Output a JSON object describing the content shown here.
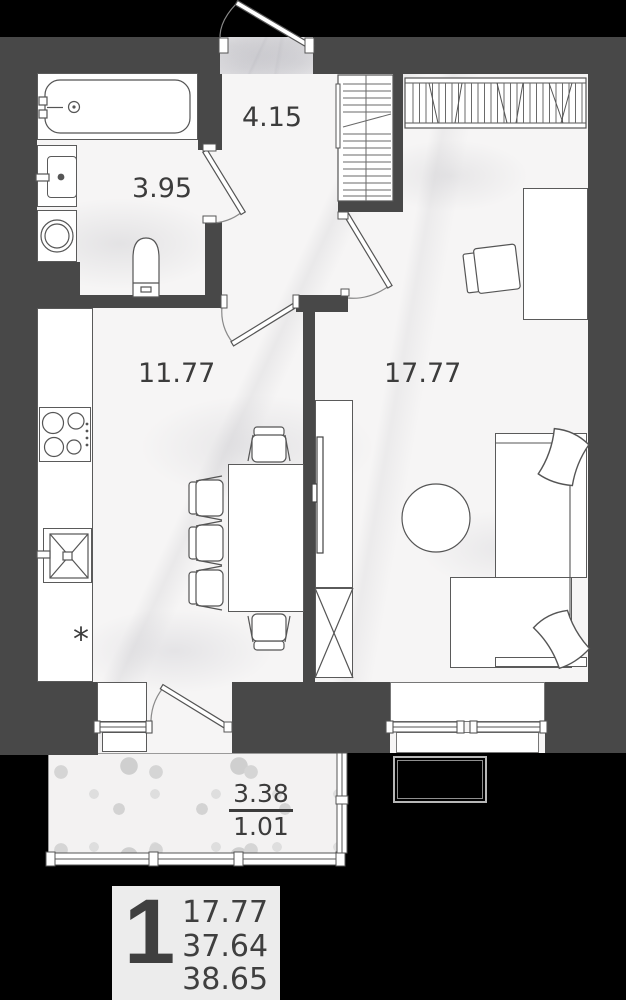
{
  "plan": {
    "rooms": [
      {
        "name": "hallway",
        "area": "4.15"
      },
      {
        "name": "bathroom",
        "area": "3.95"
      },
      {
        "name": "kitchen",
        "area": "11.77"
      },
      {
        "name": "living-room",
        "area": "17.77"
      }
    ],
    "balcony": {
      "area_total": "3.38",
      "area_counted": "1.01"
    },
    "fridge_marker": "*"
  },
  "legend": {
    "rooms_count": "1",
    "living_area": "17.77",
    "area_without_balcony": "37.64",
    "total_area": "38.65"
  },
  "colors": {
    "walls": "#484848",
    "background": "#000000",
    "floor": "#f6f5f5",
    "balcony_floor": "#f3f2f2",
    "outline": "#5a5a5a",
    "label_text": "#3c3c3c",
    "legend_bg": "#ececec"
  },
  "fixtures": [
    "bathtub",
    "washbasin",
    "washing-machine",
    "toilet",
    "built-in-closet",
    "entrance-door",
    "interior-door",
    "cooktop",
    "kitchen-sink",
    "kitchen-counter",
    "dining-table",
    "dining-chair",
    "wardrobe-hangers",
    "desk",
    "desk-chair",
    "tv-stand",
    "tv",
    "round-table",
    "bed",
    "pillow",
    "sofa",
    "window",
    "balcony-glazing",
    "air-conditioner"
  ]
}
